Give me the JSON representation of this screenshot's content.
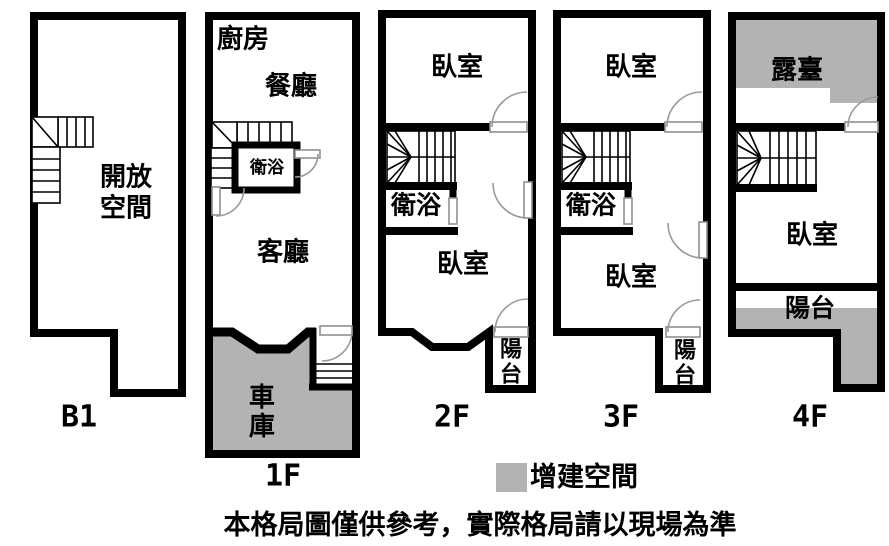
{
  "colors": {
    "wall": "#000000",
    "added_space": "#b3b3b3",
    "background": "#ffffff",
    "text": "#000000"
  },
  "floors": {
    "b1": {
      "label": "B1",
      "open_space": "開放空間"
    },
    "f1": {
      "label": "1F",
      "kitchen": "廚房",
      "dining": "餐廳",
      "bath": "衛浴",
      "living": "客廳",
      "garage": "車庫"
    },
    "f2": {
      "label": "2F",
      "bedroom_top": "臥室",
      "bath": "衛浴",
      "bedroom_bottom": "臥室",
      "balcony": "陽台"
    },
    "f3": {
      "label": "3F",
      "bedroom_top": "臥室",
      "bath": "衛浴",
      "bedroom_bottom": "臥室",
      "balcony": "陽台"
    },
    "f4": {
      "label": "4F",
      "terrace": "露臺",
      "bedroom": "臥室",
      "balcony": "陽台"
    }
  },
  "legend": {
    "label": "增建空間"
  },
  "disclaimer": "本格局圖僅供參考，實際格局請以現場為準"
}
